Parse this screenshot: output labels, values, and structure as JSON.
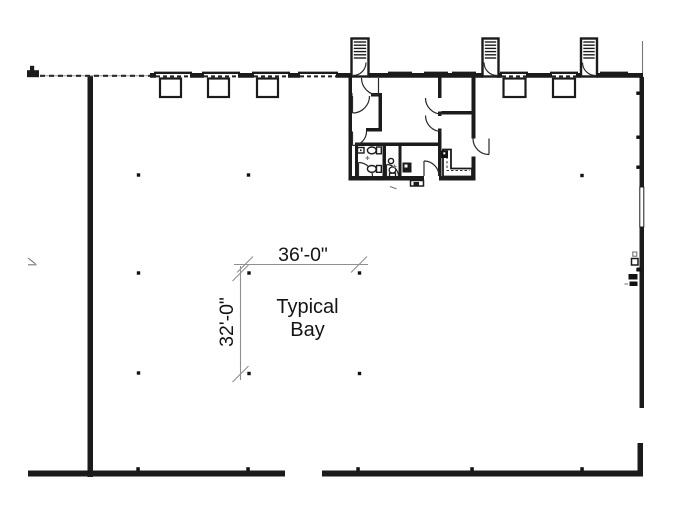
{
  "plan": {
    "annotations": {
      "bay_width": "36'-0\"",
      "bay_depth": "32'-0\"",
      "bay_label_line1": "Typical",
      "bay_label_line2": "Bay"
    },
    "colors": {
      "wall": "#1b1b1b",
      "dimension_line": "#8f8f8f",
      "text": "#141414",
      "background": "#ffffff"
    },
    "features": {
      "dock_doors_with_bumpers": 5,
      "drive_in_door_openings": 1,
      "stair_towers": 3,
      "interior_column_markers": 9
    }
  }
}
